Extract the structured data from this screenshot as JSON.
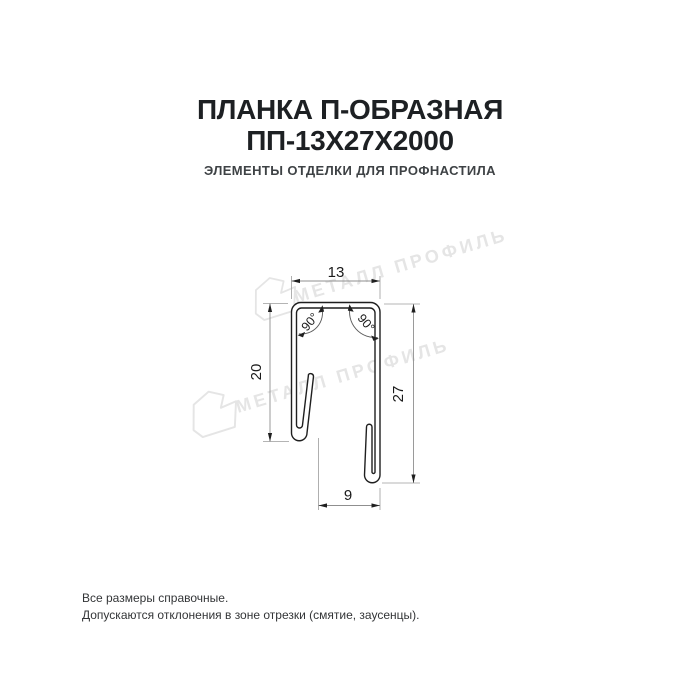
{
  "header": {
    "title_line1": "ПЛАНКА П-ОБРАЗНАЯ",
    "title_line2": "ПП-13Х27Х2000",
    "subtitle": "ЭЛЕМЕНТЫ ОТДЕЛКИ ДЛЯ ПРОФНАСТИЛА"
  },
  "drawing": {
    "dims": {
      "top_width": "13",
      "left_height": "20",
      "right_height": "27",
      "bottom_width": "9",
      "angle_left": "90°",
      "angle_right": "90°"
    },
    "colors": {
      "outline": "#1f1f1f",
      "dimension_line": "#9b9b9b",
      "dimension_text": "#1a1a1a",
      "watermark": "#e5e5e5"
    }
  },
  "watermark": {
    "text": "МЕТАЛЛ ПРОФИЛЬ"
  },
  "footer": {
    "line1": "Все размеры справочные.",
    "line2": "Допускаются отклонения в зоне отрезки (смятие, заусенцы)."
  }
}
